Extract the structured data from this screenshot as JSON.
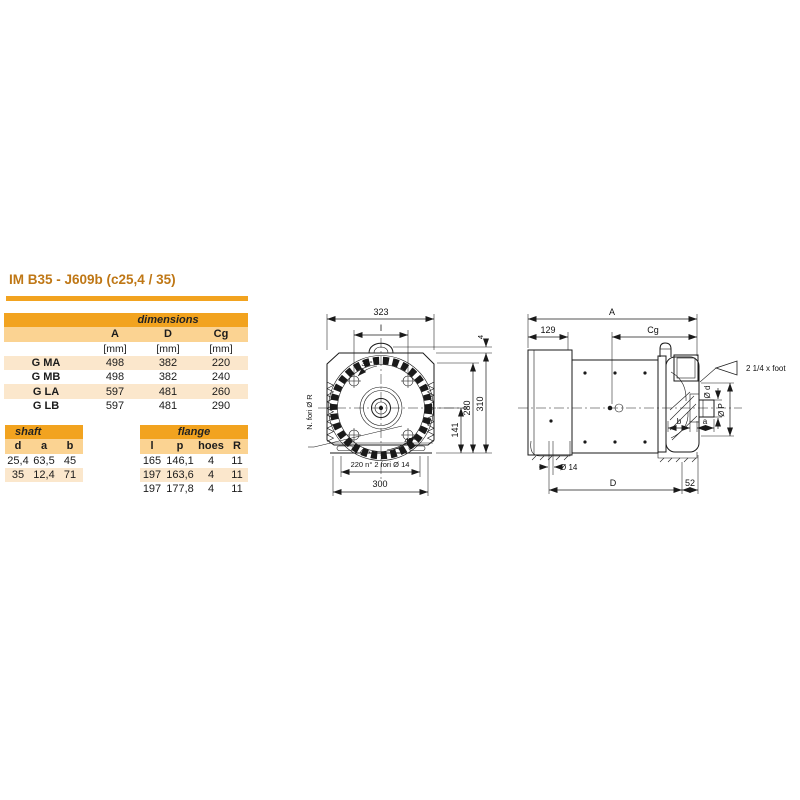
{
  "page": {
    "title": "IM B35 - J609b (c25,4 / 35)"
  },
  "colors": {
    "accent_orange": "#f2a31f",
    "accent_light": "#fbd392",
    "row_tint": "#fbe7cc",
    "title_text": "#bf7715",
    "line_color": "#1a1a1a"
  },
  "dimensions_table": {
    "title": "dimensions",
    "col_headers": [
      "A",
      "D",
      "Cg"
    ],
    "units": [
      "[mm]",
      "[mm]",
      "[mm]"
    ],
    "rows": [
      {
        "label": "G MA",
        "A": "498",
        "D": "382",
        "Cg": "220"
      },
      {
        "label": "G MB",
        "A": "498",
        "D": "382",
        "Cg": "240"
      },
      {
        "label": "G LA",
        "A": "597",
        "D": "481",
        "Cg": "260"
      },
      {
        "label": "G LB",
        "A": "597",
        "D": "481",
        "Cg": "290"
      }
    ]
  },
  "shaft_table": {
    "title": "shaft",
    "col_headers": [
      "d",
      "a",
      "b"
    ],
    "rows": [
      [
        "25,4",
        "63,5",
        "45"
      ],
      [
        "35",
        "12,4",
        "71"
      ]
    ]
  },
  "flange_table": {
    "title": "flange",
    "col_headers": [
      "l",
      "p",
      "hoes",
      "R"
    ],
    "rows": [
      [
        "165",
        "146,1",
        "4",
        "11"
      ],
      [
        "197",
        "163,6",
        "4",
        "11"
      ],
      [
        "197",
        "177,8",
        "4",
        "11"
      ]
    ]
  },
  "front_view": {
    "width_dim": "323",
    "bolt_span_dim": "l",
    "angle_top": "30°",
    "angle_bottom": "45°",
    "holes_note": "N. fori Ø R",
    "foot_holes_dim": "220 n° 2 fori Ø 14",
    "base_width_dim": "300",
    "center_height_dim": "141",
    "flange_height_dim": "280",
    "total_height_dim": "310",
    "lug_offset_dim": "4"
  },
  "side_view": {
    "total_length_dim": "A",
    "rear_length_dim": "129",
    "cg_dim": "Cg",
    "foot_note": "2 1/4 x foot",
    "shaft_dia_dim": "Ø d",
    "pilot_dia_dim": "Ø P",
    "dim_b": "b",
    "dim_a": "a",
    "foot_hole_dim": "Ø 14",
    "dim_D": "D",
    "dim_52": "52"
  }
}
